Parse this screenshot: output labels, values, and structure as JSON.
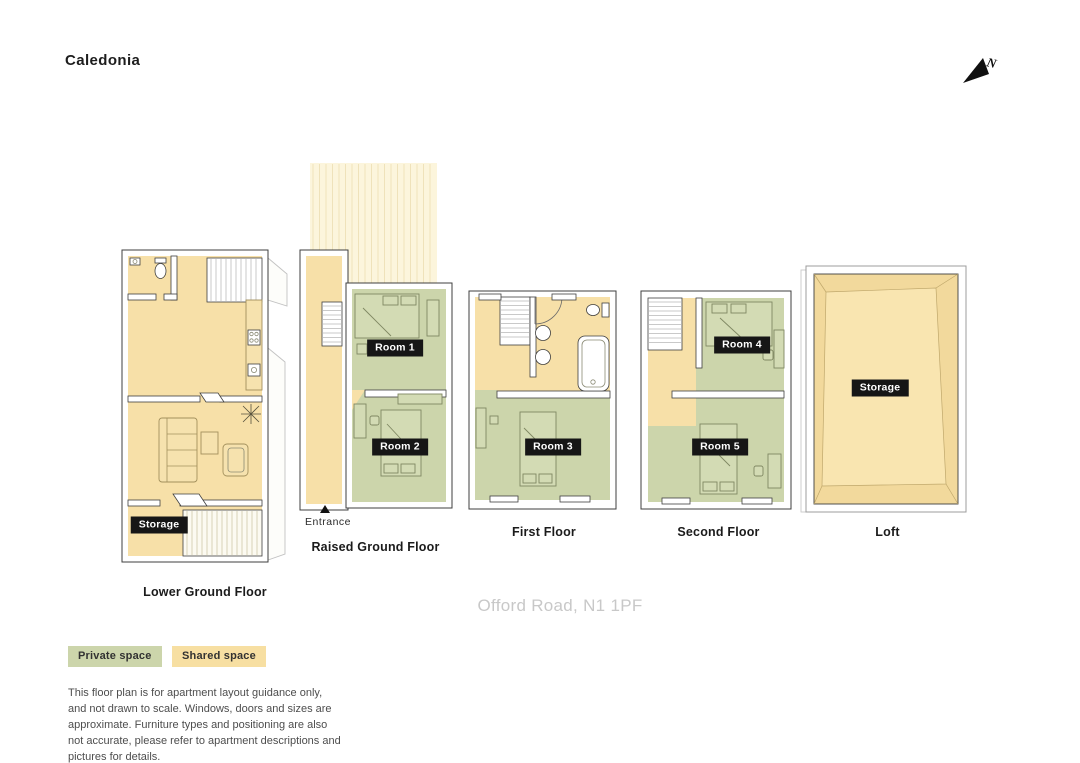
{
  "title": "Caledonia",
  "address": "Offord Road, N1 1PF",
  "north_arrow": {
    "letter": "N"
  },
  "colors": {
    "private_space": "#ccd5ab",
    "shared_space": "#f7e0a8",
    "badge_bg": "#161616",
    "badge_text": "#ffffff"
  },
  "floors": [
    {
      "label": "Lower Ground Floor",
      "badges": [
        {
          "text": "Storage"
        }
      ]
    },
    {
      "label": "Raised Ground Floor",
      "entrance": "Entrance",
      "badges": [
        {
          "text": "Room 1"
        },
        {
          "text": "Room 2"
        }
      ]
    },
    {
      "label": "First Floor",
      "badges": [
        {
          "text": "Room 3"
        }
      ]
    },
    {
      "label": "Second Floor",
      "badges": [
        {
          "text": "Room 4"
        },
        {
          "text": "Room 5"
        }
      ]
    },
    {
      "label": "Loft",
      "badges": [
        {
          "text": "Storage"
        }
      ]
    }
  ],
  "legend": [
    {
      "label": "Private space",
      "color": "#ccd5ab"
    },
    {
      "label": "Shared space",
      "color": "#f7dfa2"
    }
  ],
  "disclaimer": "This floor plan is for apartment layout guidance only, and not drawn to scale. Windows, doors and sizes are approximate. Furniture types and positioning are also not accurate, please refer to apartment descriptions and pictures for details."
}
